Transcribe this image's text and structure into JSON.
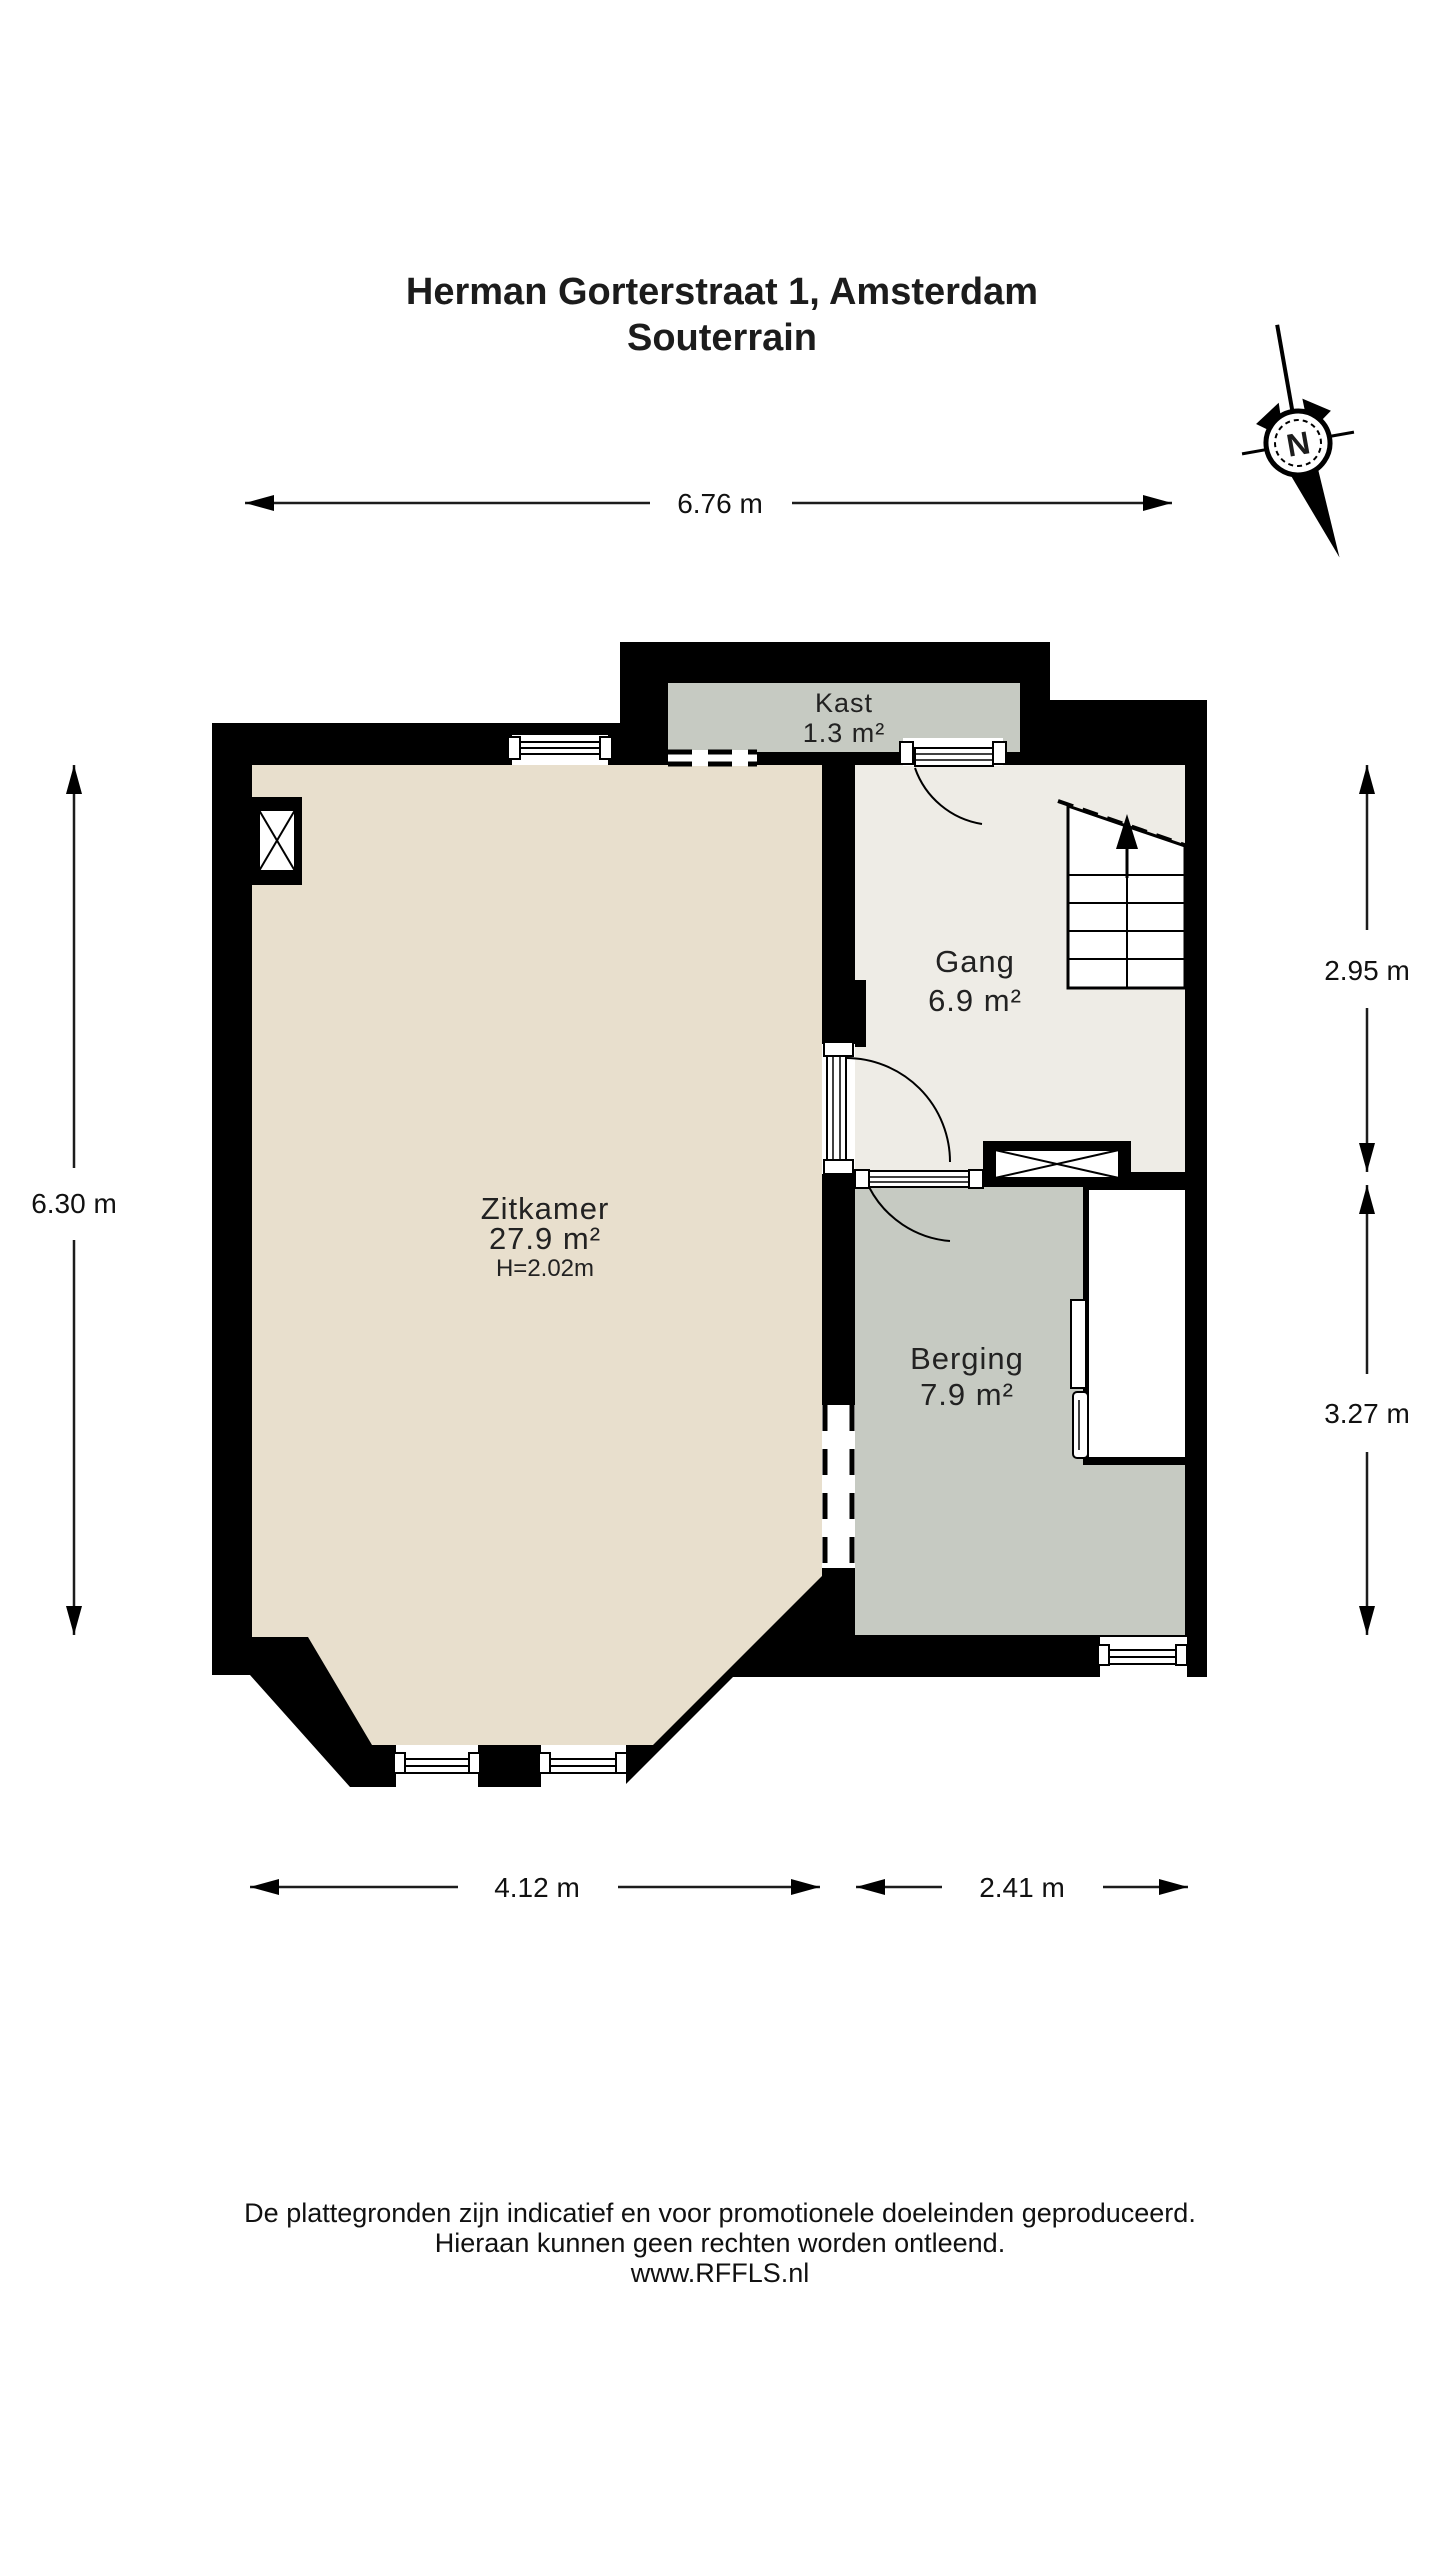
{
  "title": {
    "line1": "Herman Gorterstraat 1, Amsterdam",
    "line2": "Souterrain"
  },
  "compass": {
    "north_label": "N"
  },
  "dimensions": {
    "top": "6.76 m",
    "left": "6.30 m",
    "right_upper": "2.95 m",
    "right_lower": "3.27 m",
    "bottom_left": "4.12 m",
    "bottom_right": "2.41 m"
  },
  "rooms": {
    "zitkamer": {
      "name": "Zitkamer",
      "area": "27.9 m²",
      "ceiling_height": "H=2.02m",
      "fill": "#e8dfcd"
    },
    "gang": {
      "name": "Gang",
      "area": "6.9 m²",
      "fill": "#eeece6"
    },
    "berging": {
      "name": "Berging",
      "area": "7.9 m²",
      "fill": "#c6cac2"
    },
    "kast": {
      "name": "Kast",
      "area": "1.3 m²",
      "fill": "#c6cac2"
    }
  },
  "footer": {
    "line1": "De plattegronden zijn indicatief en voor promotionele doeleinden geproduceerd.",
    "line2": "Hieraan kunnen geen rechten worden ontleend.",
    "line3": "www.RFFLS.nl"
  },
  "colors": {
    "wall": "#000000",
    "background": "#ffffff",
    "text": "#1c1c1c"
  }
}
